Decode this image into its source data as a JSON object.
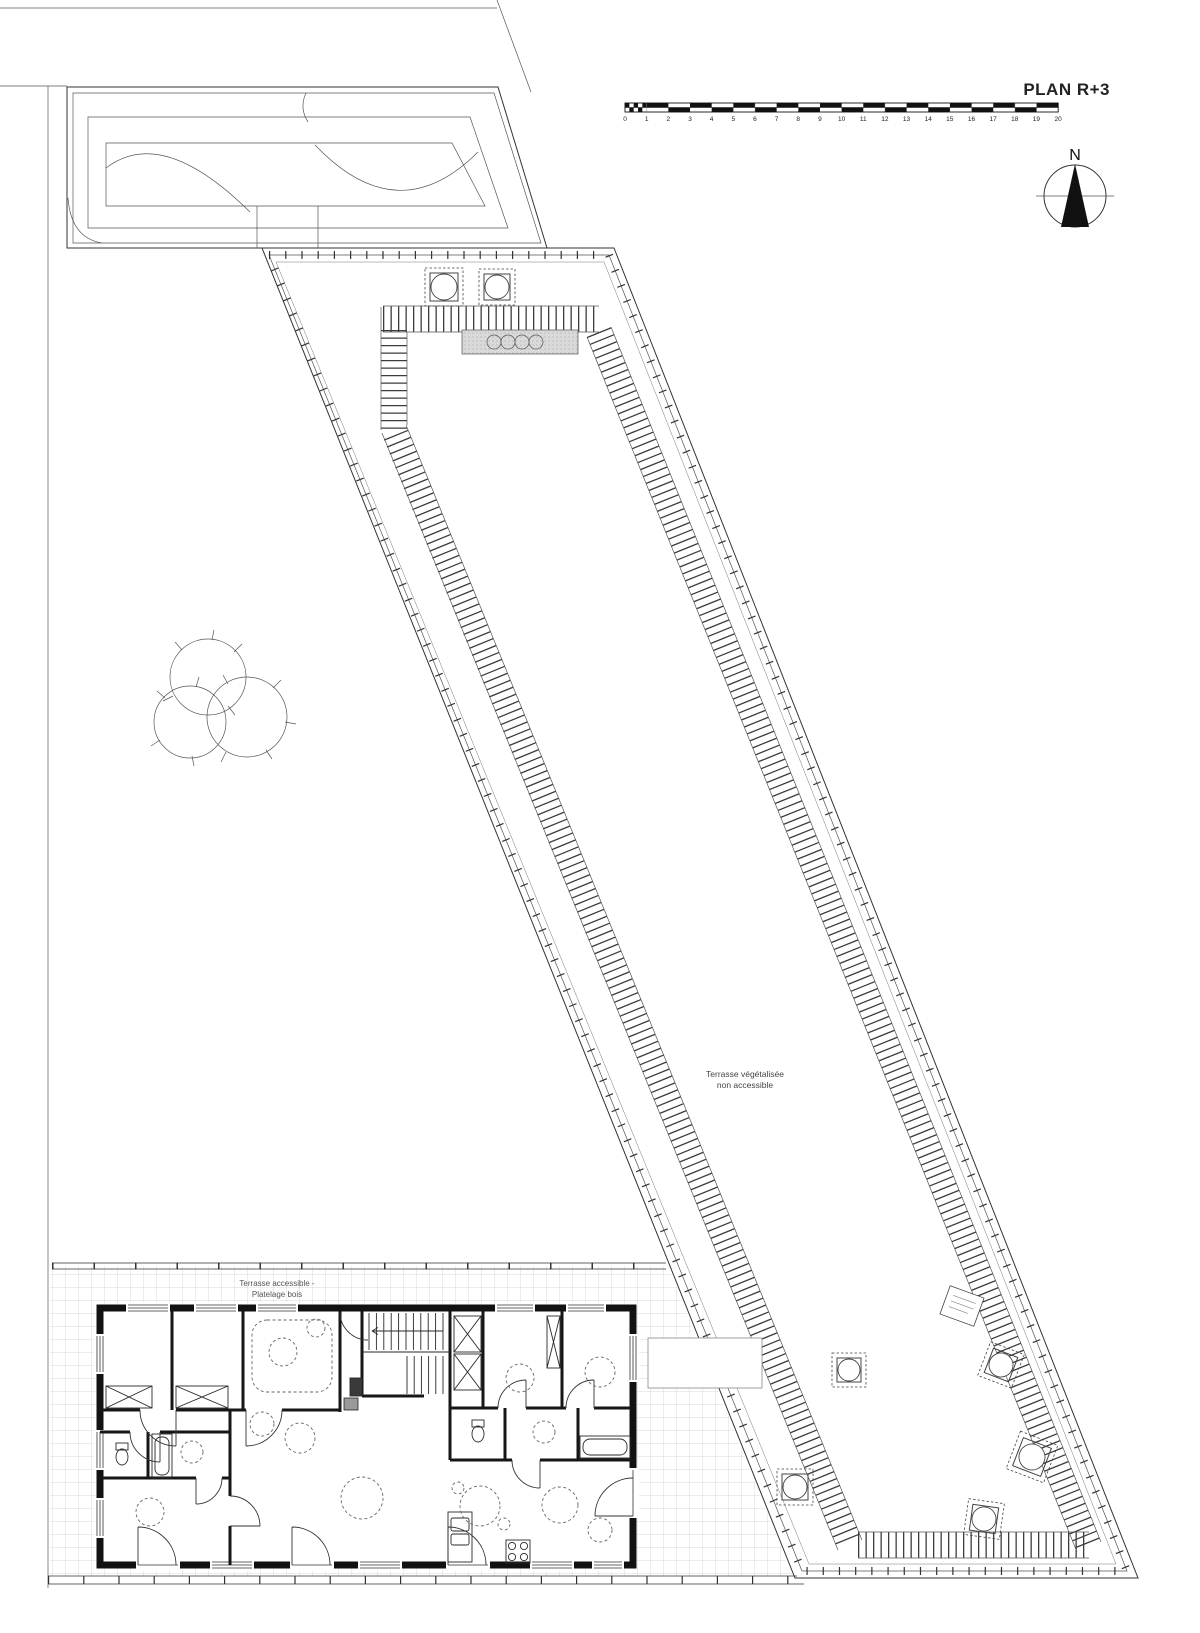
{
  "title": {
    "label": "PLAN R+3"
  },
  "scale_bar": {
    "unit_labels": [
      "0",
      "1",
      "2",
      "3",
      "4",
      "5",
      "6",
      "7",
      "8",
      "9",
      "10",
      "11",
      "12",
      "13",
      "14",
      "15",
      "16",
      "17",
      "18",
      "19",
      "20"
    ]
  },
  "compass": {
    "north_label": "N"
  },
  "roof": {
    "label_line1": "Terrasse végétalisée",
    "label_line2": "non accessible"
  },
  "terrace": {
    "label_line1": "Terrasse accessible -",
    "label_line2": "Platelage bois"
  },
  "colors": {
    "ink": "#1a1a1a",
    "hatch": "#3c3c3c",
    "grid": "#cccccc",
    "gray_fill": "#d9d9d9"
  }
}
